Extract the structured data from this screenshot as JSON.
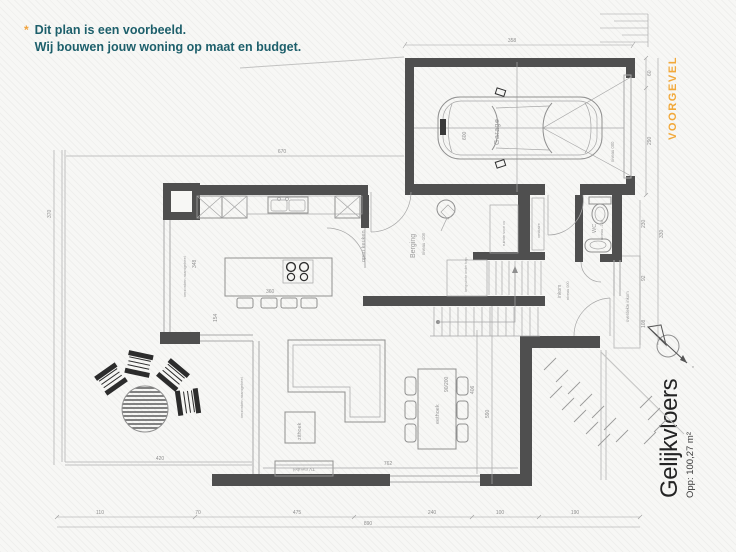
{
  "note": {
    "marker": "*",
    "line1": "Dit plan is een voorbeeld.",
    "line2": "Wij bouwen jouw woning op maat en budget."
  },
  "side_labels": {
    "voorgevel": "VOORGEVEL",
    "floor_name": "Gelijkvloers",
    "floor_area": "Opp: 100,27 m²"
  },
  "rooms": {
    "garage": "Garage",
    "garage_level": "niveau 000",
    "berging": "Berging",
    "berging_level": "niveau -108",
    "keuken": "open keuken",
    "zithoek": "zithoek",
    "eethoek": "eethoek",
    "tv": "TV meubel",
    "wc": "WC",
    "wc_level": "niveau -108",
    "inkom": "inkom",
    "inkom_level": "niveau 000",
    "overdekte_inkom": "overdekte inkom",
    "vestiaire": "vestiaire",
    "cv": "ruimte voor cv",
    "onder_trap": "bergruimte onder trap",
    "raam_keuken": "verzonken raamgeheel",
    "raam_living": "verzonken raamgeheel"
  },
  "dims": {
    "top_358": "358",
    "garage_600": "600",
    "setback_670": "670",
    "right_60": "60",
    "right_290": "290",
    "right_330": "330",
    "right_230": "230",
    "right_92": "92",
    "right_108": "108",
    "left_370": "370",
    "bottom": [
      "110",
      "70",
      "475",
      "240",
      "100",
      "190"
    ],
    "bottom_total": "890",
    "terrace_420": "420",
    "island_360": "360",
    "k_348": "348",
    "k_154": "154",
    "l_406": "406",
    "l_590": "590",
    "l_762": "762",
    "table_90_200": "90/200"
  },
  "colors": {
    "accent": "#f0a23c",
    "note_teal": "#1d5f6b",
    "wall": "#4f4f4f",
    "lines": "#9a9a9a",
    "labels": "#9b9b9b"
  }
}
